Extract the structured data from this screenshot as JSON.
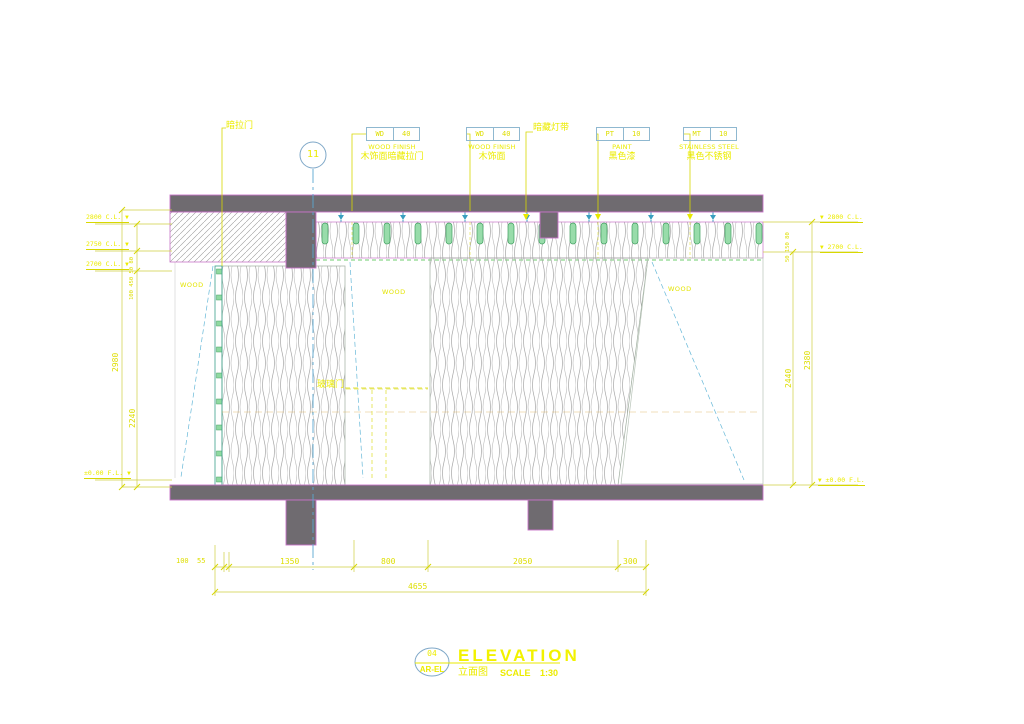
{
  "title_block": {
    "number": "04",
    "code": "AR-EL",
    "title": "ELEVATION",
    "subtitle_cn": "立面图",
    "scale_label": "SCALE",
    "scale_value": "1:30"
  },
  "datum_bubble": "11",
  "callouts": {
    "hidden_door": "暗拉门",
    "cove_light": "暗藏灯带",
    "glass_door": "玻璃门",
    "wood_left": "WOOD",
    "wood_mid": "WOOD",
    "wood_right": "WOOD",
    "tags": [
      {
        "code": "WD",
        "num": "40",
        "en": "WOOD FINISH",
        "cn": "木饰面暗藏拉门"
      },
      {
        "code": "WD",
        "num": "40",
        "en": "WOOD FINISH",
        "cn": "木饰面"
      },
      {
        "code": "PT",
        "num": "10",
        "en": "PAINT",
        "cn": "黑色漆"
      },
      {
        "code": "MT",
        "num": "10",
        "en": "STAINLESS STEEL",
        "cn": "黑色不锈钢"
      }
    ]
  },
  "dims": {
    "left_outer": "2980",
    "left_inner": "2240",
    "left_stack": "100 450 50 80",
    "right_inner": "2440",
    "right_outer": "2380",
    "right_stack": "50 150 80",
    "bottom_segments": [
      "100",
      "55",
      "1350",
      "800",
      "2050",
      "300"
    ],
    "bottom_total": "4655",
    "marker_glyph": "▼",
    "left_levels": [
      {
        "text": "2800 C.L."
      },
      {
        "text": "2750 C.L."
      },
      {
        "text": "2700 C.L."
      },
      {
        "text": "±0.00 F.L."
      }
    ],
    "right_levels": [
      {
        "text": "2800 C.L."
      },
      {
        "text": "2700 C.L."
      },
      {
        "text": "±0.00 F.L."
      }
    ]
  },
  "colors": {
    "annotation_yellow": "#ecec00",
    "dim_yellow": "#d6d600",
    "structure_gray": "#6f6b70",
    "outline_magenta": "#c873c8",
    "line_cyan": "#66b8d8",
    "datum_blue": "#7fa8c8",
    "accent_green": "#8fd9a0",
    "background": "#ffffff"
  }
}
